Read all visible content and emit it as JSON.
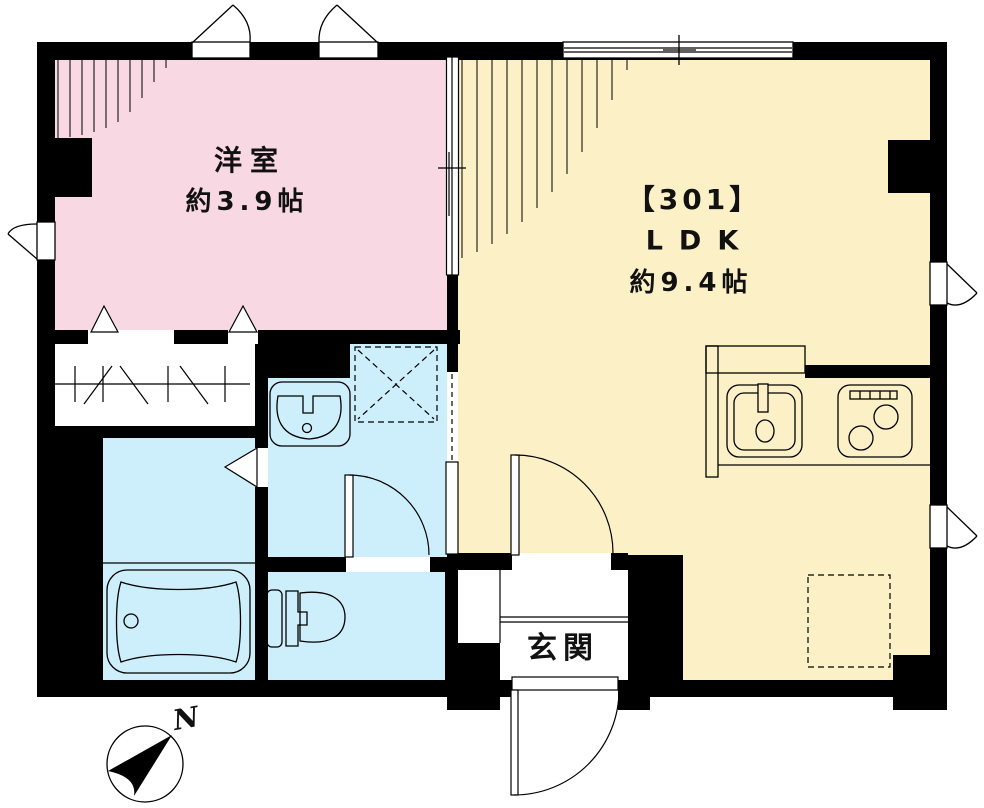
{
  "floorplan": {
    "title": "Unit 301 floor plan",
    "compass": {
      "label": "N"
    },
    "rooms": {
      "western_room": {
        "name": "洋室",
        "area": "約3.9帖"
      },
      "ldk": {
        "unit": "【301】",
        "name": "LDK",
        "area": "約9.4帖"
      },
      "entrance": {
        "name": "玄関"
      },
      "bathroom": {
        "name": "bathroom"
      },
      "washroom": {
        "name": "washroom"
      },
      "toilet": {
        "name": "toilet-room"
      },
      "closet": {
        "name": "closet"
      }
    },
    "fixtures": [
      "bathtub",
      "toilet",
      "washbasin",
      "washing-machine-space",
      "kitchen-sink",
      "gas-stove",
      "kitchen-counter",
      "refrigerator-space",
      "closet-hanger-pipe",
      "entrance-step"
    ],
    "openings": [
      "awning-window-top-left",
      "awning-window-top-right",
      "sliding-window-top",
      "awning-window-left",
      "awning-window-right-upper",
      "awning-window-right-lower",
      "sliding-partition-western-ldk",
      "closet-hinged-doors",
      "bathroom-folding-door",
      "washroom-toilet-door",
      "washroom-pocket-door",
      "ldk-entrance-door",
      "front-door"
    ],
    "colors": {
      "wall": "#000000",
      "background": "#ffffff",
      "western_room": "#f8d8e3",
      "ldk": "#fbf0c6",
      "water_rooms": "#cdeffb",
      "line": "#000000",
      "text": "#111111"
    }
  }
}
